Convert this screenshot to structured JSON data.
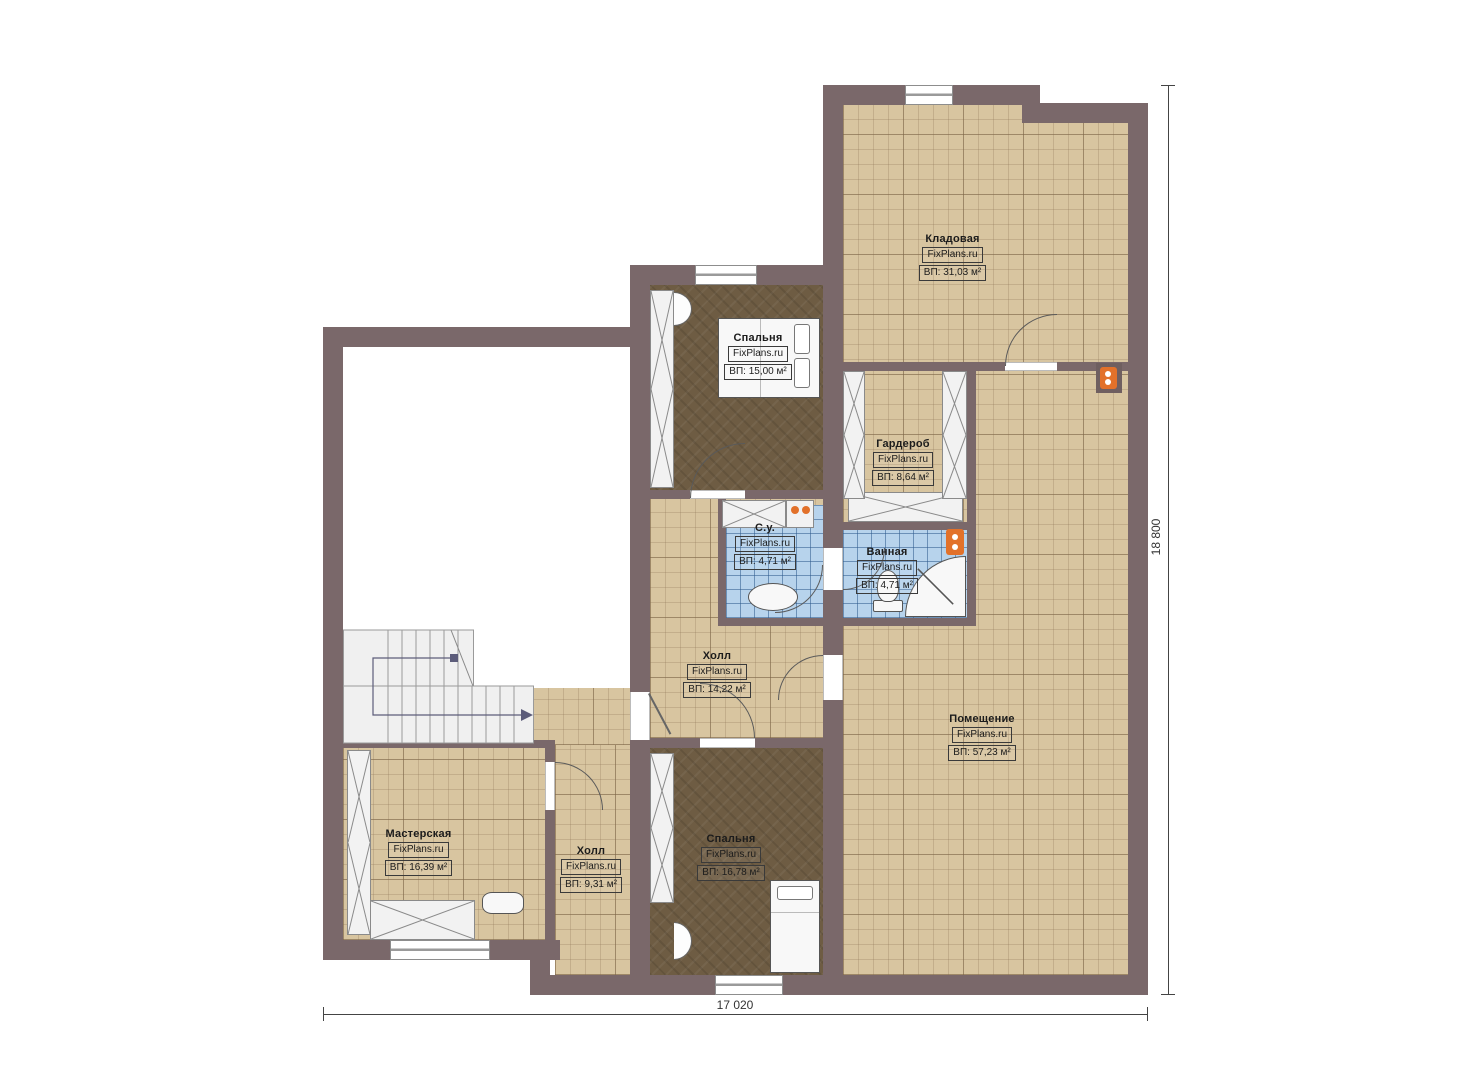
{
  "plan": {
    "type": "floor-plan",
    "brand": "FixPlans.ru",
    "rooms": [
      {
        "id": "kladovaya",
        "label": "Кладовая",
        "brand": "FixPlans.ru",
        "area": "ВП: 31,03 м²"
      },
      {
        "id": "spalnya-verh",
        "label": "Спальня",
        "brand": "FixPlans.ru",
        "area": "ВП: 15,00 м²"
      },
      {
        "id": "garderob",
        "label": "Гардероб",
        "brand": "FixPlans.ru",
        "area": "ВП: 8,64 м²"
      },
      {
        "id": "sanuzel",
        "label": "С.у.",
        "brand": "FixPlans.ru",
        "area": "ВП: 4,71 м²"
      },
      {
        "id": "vannaya",
        "label": "Ванная",
        "brand": "FixPlans.ru",
        "area": "ВП: 4,71 м²"
      },
      {
        "id": "holl-verh",
        "label": "Холл",
        "brand": "FixPlans.ru",
        "area": "ВП: 14,22 м²"
      },
      {
        "id": "pomeshchenie",
        "label": "Помещение",
        "brand": "FixPlans.ru",
        "area": "ВП: 57,23 м²"
      },
      {
        "id": "masterskaya",
        "label": "Мастерская",
        "brand": "FixPlans.ru",
        "area": "ВП: 16,39 м²"
      },
      {
        "id": "holl-niz",
        "label": "Холл",
        "brand": "FixPlans.ru",
        "area": "ВП: 9,31 м²"
      },
      {
        "id": "spalnya-niz",
        "label": "Спальня",
        "brand": "FixPlans.ru",
        "area": "ВП: 16,78 м²"
      }
    ],
    "dimensions": {
      "width": "17 020",
      "height": "18 800"
    },
    "colors": {
      "wall": "#7a686a",
      "floor_tan": "#d8c5a0",
      "floor_wood": "#6e5c43",
      "floor_tile": "#b7d3ec",
      "accent_orange": "#e2712a"
    }
  }
}
